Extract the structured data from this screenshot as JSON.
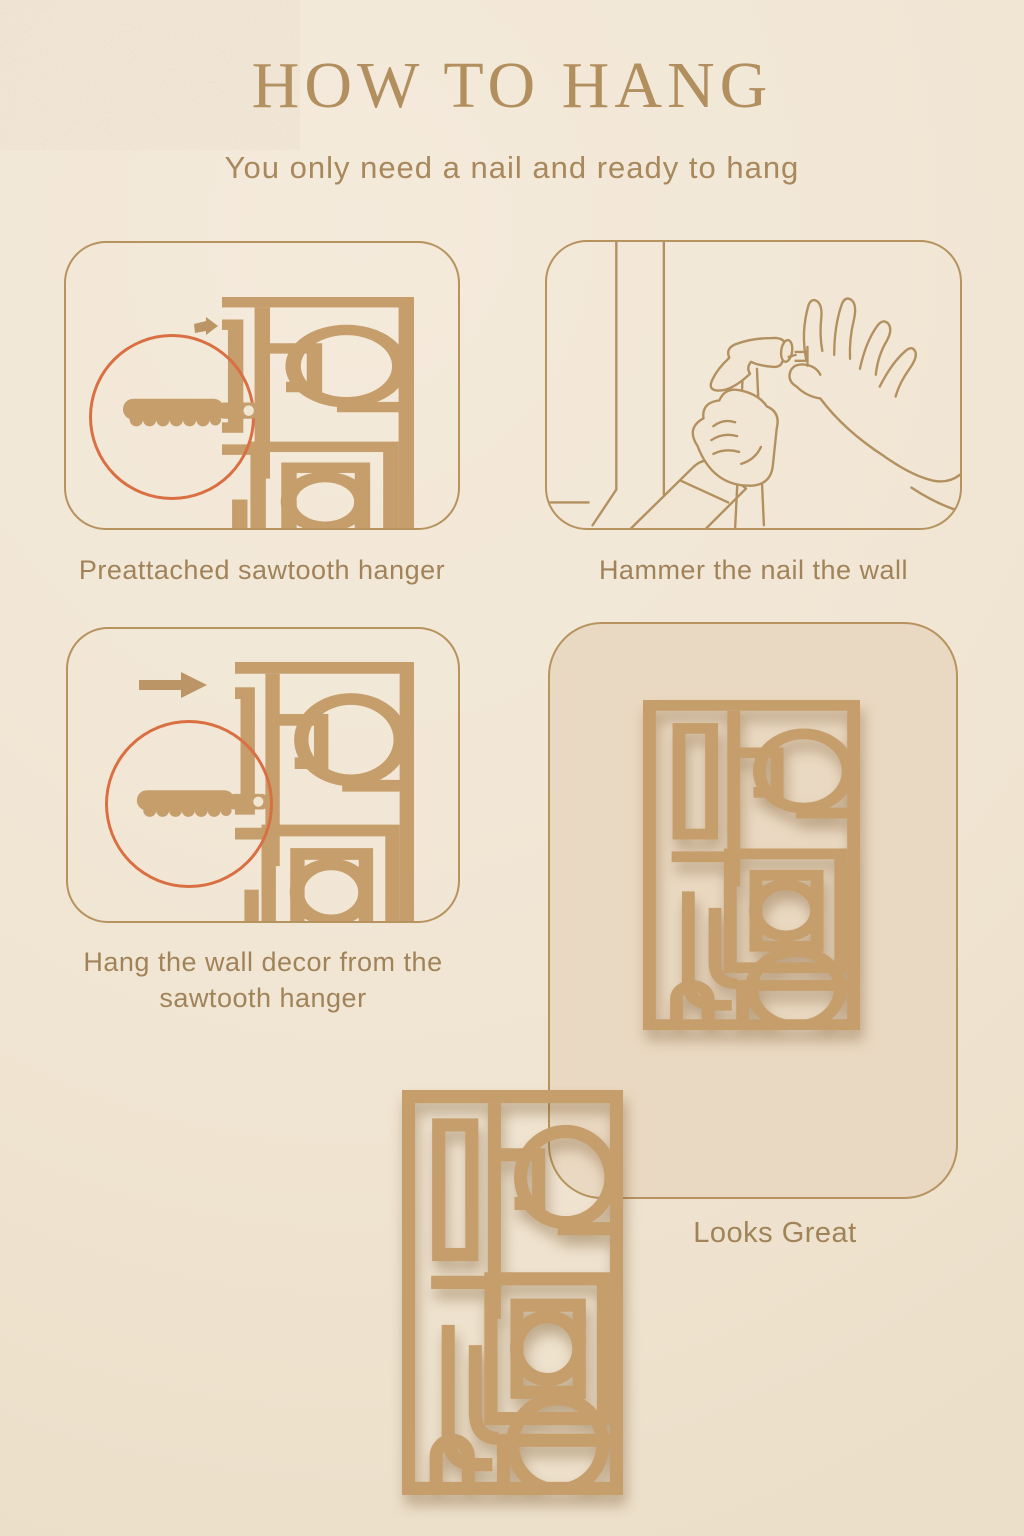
{
  "poster": {
    "title": "HOW TO HANG",
    "subtitle": "You only need a nail and ready to hang"
  },
  "steps": [
    {
      "caption": "Preattached sawtooth hanger",
      "illustration": "back of wall decor with small arrow and circled close-up of the preattached sawtooth hanger"
    },
    {
      "caption": "Hammer the nail the wall",
      "illustration": "hand holding a hammer, second hand pinching a nail against the wall"
    },
    {
      "caption": "Hang the wall decor from the sawtooth hanger",
      "illustration": "arrow pushing the wall decor toward the wall with circled sawtooth hanger close-up"
    },
    {
      "caption": "Looks Great",
      "illustration": "geometric openwork wall decor hanging on the wall"
    }
  ],
  "icons": [
    "sawtooth-hanger-icon",
    "direction-arrow-icon",
    "zoom-circle-outline",
    "hammer-icon",
    "hand-holding-nail-icon",
    "wall-decor-graphic"
  ],
  "colors": {
    "page_background": "#f1e6d4",
    "panel_fill": "#ead9c2",
    "decor_tan": "#c59e6c",
    "line_art": "#b2905f",
    "accent_red": "#d96f42",
    "caption_text": "#a1835a",
    "title_text": "#b28f5e"
  }
}
